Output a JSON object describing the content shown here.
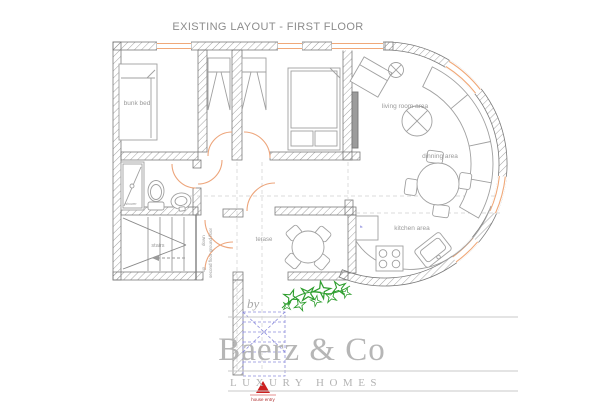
{
  "title": "EXISTING LAYOUT - FIRST FLOOR",
  "rooms": {
    "bunk_bed": "bunk bed",
    "living_room": "living room area",
    "dining": "dinning area",
    "kitchen": "kitchen area",
    "terrace": "terase",
    "stairs": "stairs",
    "shower": "shower",
    "fridge": "fr."
  },
  "stairs_notes": {
    "down": "down",
    "down_to": "ground floor",
    "up": "up",
    "up_to": "second floor"
  },
  "entry": {
    "label": "house entry"
  },
  "logo": {
    "by": "by",
    "name": "Baerz & Co",
    "tagline": "LUXURY HOMES"
  },
  "colors": {
    "wall_hatch": "#8a8a8a",
    "door": "#eda57b",
    "window": "#f0a878",
    "label": "#9a9a9a",
    "entry_marker": "#cc2020",
    "plan_blue": "#8080d8",
    "plant": "#2e9e2e",
    "logo_gray": "#b3b3b3"
  }
}
